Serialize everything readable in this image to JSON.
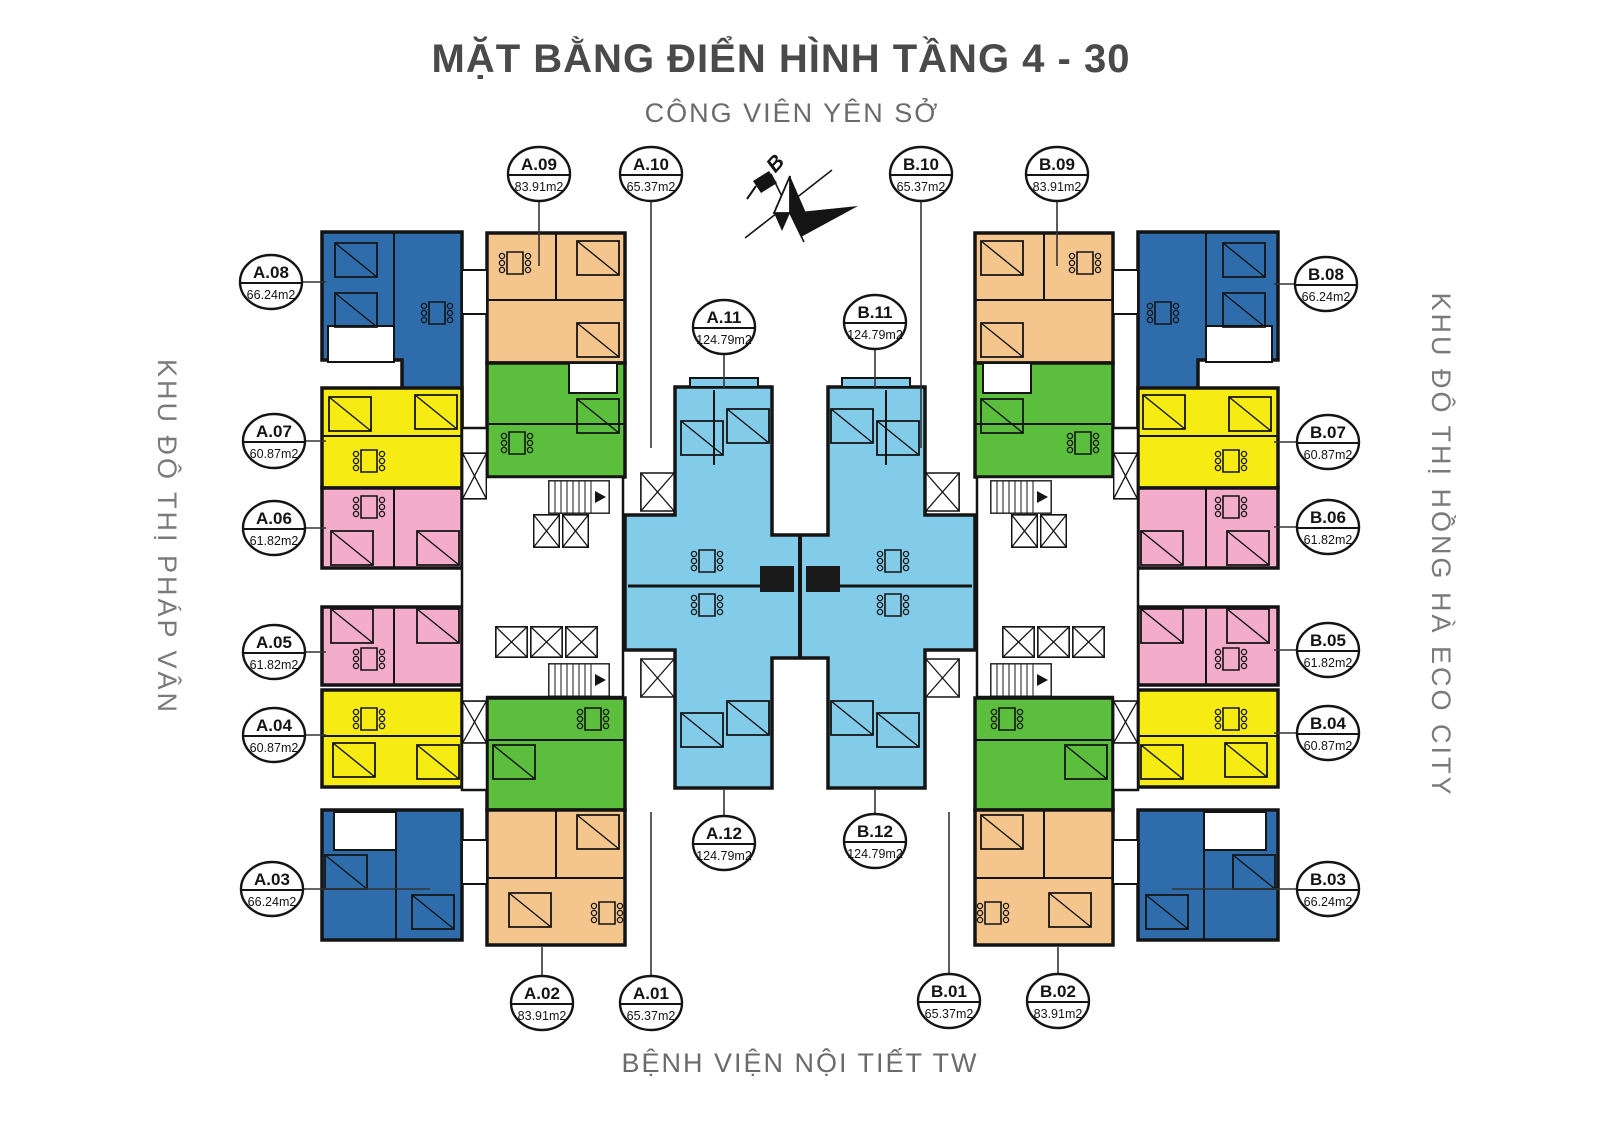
{
  "title": "MẶT BẰNG ĐIỂN HÌNH TẦNG 4 - 30",
  "context_labels": {
    "north": "CÔNG VIÊN YÊN SỞ",
    "west": "KHU ĐÔ THỊ PHÁP VÂN",
    "east": "KHU ĐÔ THỊ HỒNG HÀ ECO CITY",
    "south": "BỆNH VIỆN NỘI TIẾT TW"
  },
  "compass": {
    "north_letter": "B"
  },
  "colors": {
    "corner_unit_blue": "#2e6cac",
    "orange_unit": "#f4c68e",
    "green_unit": "#5cbe3d",
    "yellow_unit": "#f6ec14",
    "pink_unit": "#f3adca",
    "center_unit_blue": "#82cbe9",
    "wall": "#141414",
    "title_text": "#4a4a4a",
    "label_text": "#767676"
  },
  "units": {
    "a01": {
      "label": "A.01",
      "area": "65.37m2"
    },
    "a02": {
      "label": "A.02",
      "area": "83.91m2"
    },
    "a03": {
      "label": "A.03",
      "area": "66.24m2"
    },
    "a04": {
      "label": "A.04",
      "area": "60.87m2"
    },
    "a05": {
      "label": "A.05",
      "area": "61.82m2"
    },
    "a06": {
      "label": "A.06",
      "area": "61.82m2"
    },
    "a07": {
      "label": "A.07",
      "area": "60.87m2"
    },
    "a08": {
      "label": "A.08",
      "area": "66.24m2"
    },
    "a09": {
      "label": "A.09",
      "area": "83.91m2"
    },
    "a10": {
      "label": "A.10",
      "area": "65.37m2"
    },
    "a11": {
      "label": "A.11",
      "area": "124.79m2"
    },
    "a12": {
      "label": "A.12",
      "area": "124.79m2"
    },
    "b01": {
      "label": "B.01",
      "area": "65.37m2"
    },
    "b02": {
      "label": "B.02",
      "area": "83.91m2"
    },
    "b03": {
      "label": "B.03",
      "area": "66.24m2"
    },
    "b04": {
      "label": "B.04",
      "area": "60.87m2"
    },
    "b05": {
      "label": "B.05",
      "area": "61.82m2"
    },
    "b06": {
      "label": "B.06",
      "area": "61.82m2"
    },
    "b07": {
      "label": "B.07",
      "area": "60.87m2"
    },
    "b08": {
      "label": "B.08",
      "area": "66.24m2"
    },
    "b09": {
      "label": "B.09",
      "area": "83.91m2"
    },
    "b10": {
      "label": "B.10",
      "area": "65.37m2"
    },
    "b11": {
      "label": "B.11",
      "area": "124.79m2"
    },
    "b12": {
      "label": "B.12",
      "area": "124.79m2"
    }
  }
}
